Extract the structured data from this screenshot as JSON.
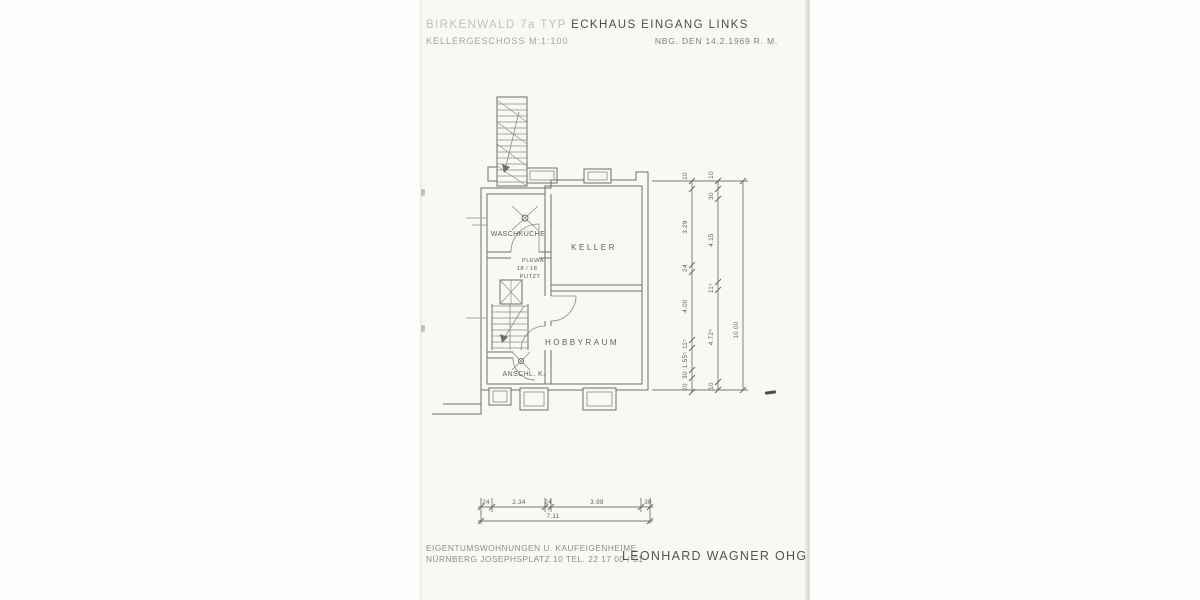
{
  "header": {
    "project_faded": "BIRKENWALD  7a  TYP",
    "project_main": "ECKHAUS EINGANG LINKS",
    "floor": "KELLERGESCHOSS  M:1:100",
    "date_note": "NBG. DEN 14.2.1969  R. M."
  },
  "plan": {
    "room_waschkueche": "WASCHKÜCHE",
    "room_keller": "KELLER",
    "room_hobbyraum": "HOBBYRAUM",
    "room_anschluss": "ANSCHL. K.",
    "chimney_line1": "PLEWA",
    "chimney_line2": "18 / 18",
    "chimney_line3": "PUTZT"
  },
  "dims": {
    "right_a": [
      "10",
      "3.29",
      "24",
      "4.00",
      "11⁵",
      "1.55⁵",
      "30",
      "20"
    ],
    "right_b": [
      "10",
      "30",
      "4.15",
      "11⁵",
      "4.72⁵",
      "10"
    ],
    "right_total": "10.00",
    "bottom": [
      "24",
      "2.34",
      "24",
      "3.99",
      "30"
    ],
    "bottom_total": "7.11"
  },
  "footer": {
    "line1": "EIGENTUMSWOHNUNGEN   U. KAUFEIGENHEIME",
    "line2": "NÜRNBERG   JOSEPHSPLATZ 10    TEL. 22 17 00 / 01",
    "company": "LEONHARD WAGNER OHG"
  }
}
